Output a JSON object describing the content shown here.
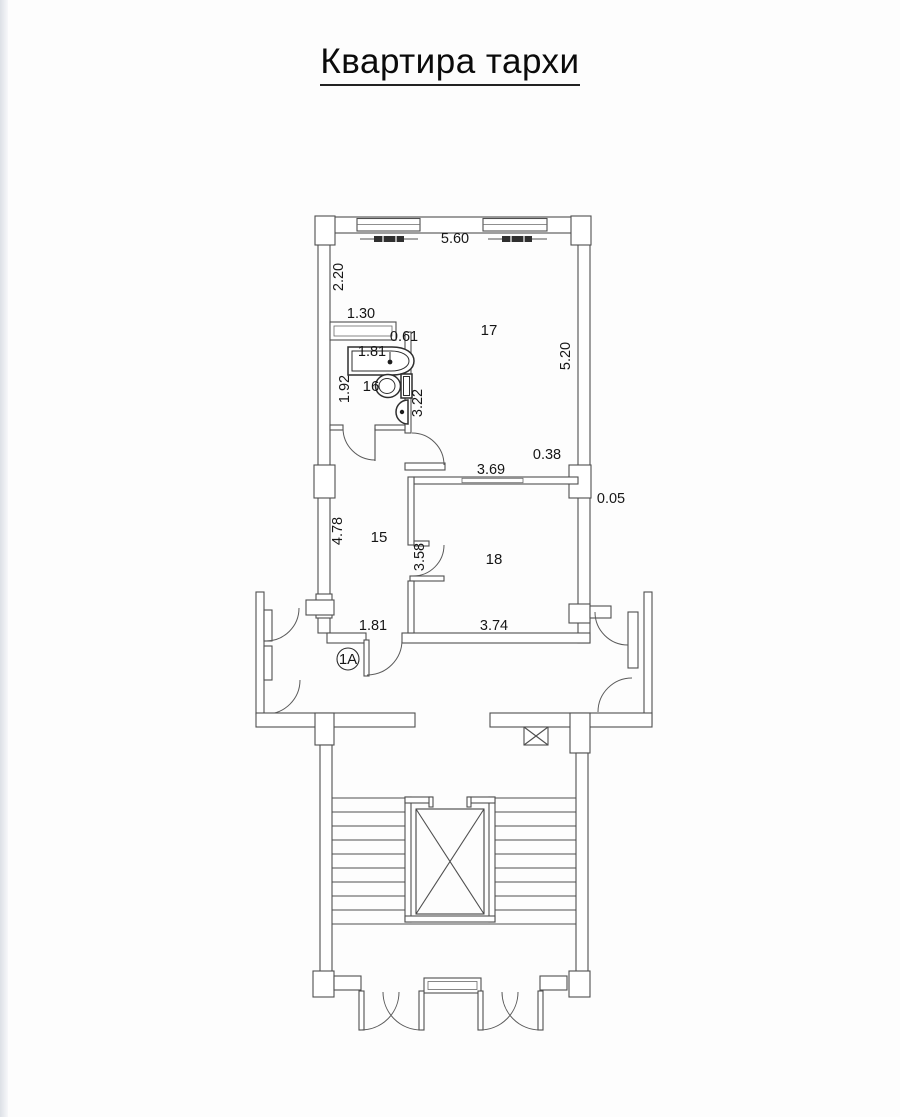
{
  "page": {
    "title": "Квартира тархи"
  },
  "plan": {
    "unit_label": "1A",
    "rooms": {
      "hall": "15",
      "bathroom": "16",
      "living": "17",
      "bedroom": "18"
    },
    "dims": {
      "top_width": "5.60",
      "left_upper": "2.20",
      "shelf_width": "1.30",
      "shelf_gap": "0.61",
      "tub_length": "1.81",
      "bath_left_side": "1.92",
      "bath_right_wall": "3.22",
      "right_side": "5.20",
      "niche_offset": "0.38",
      "partition_length": "3.69",
      "wall_offset": "0.05",
      "hall_left_side": "4.78",
      "hall_partition": "3.58",
      "entry_width": "1.81",
      "room18_width": "3.74"
    }
  }
}
